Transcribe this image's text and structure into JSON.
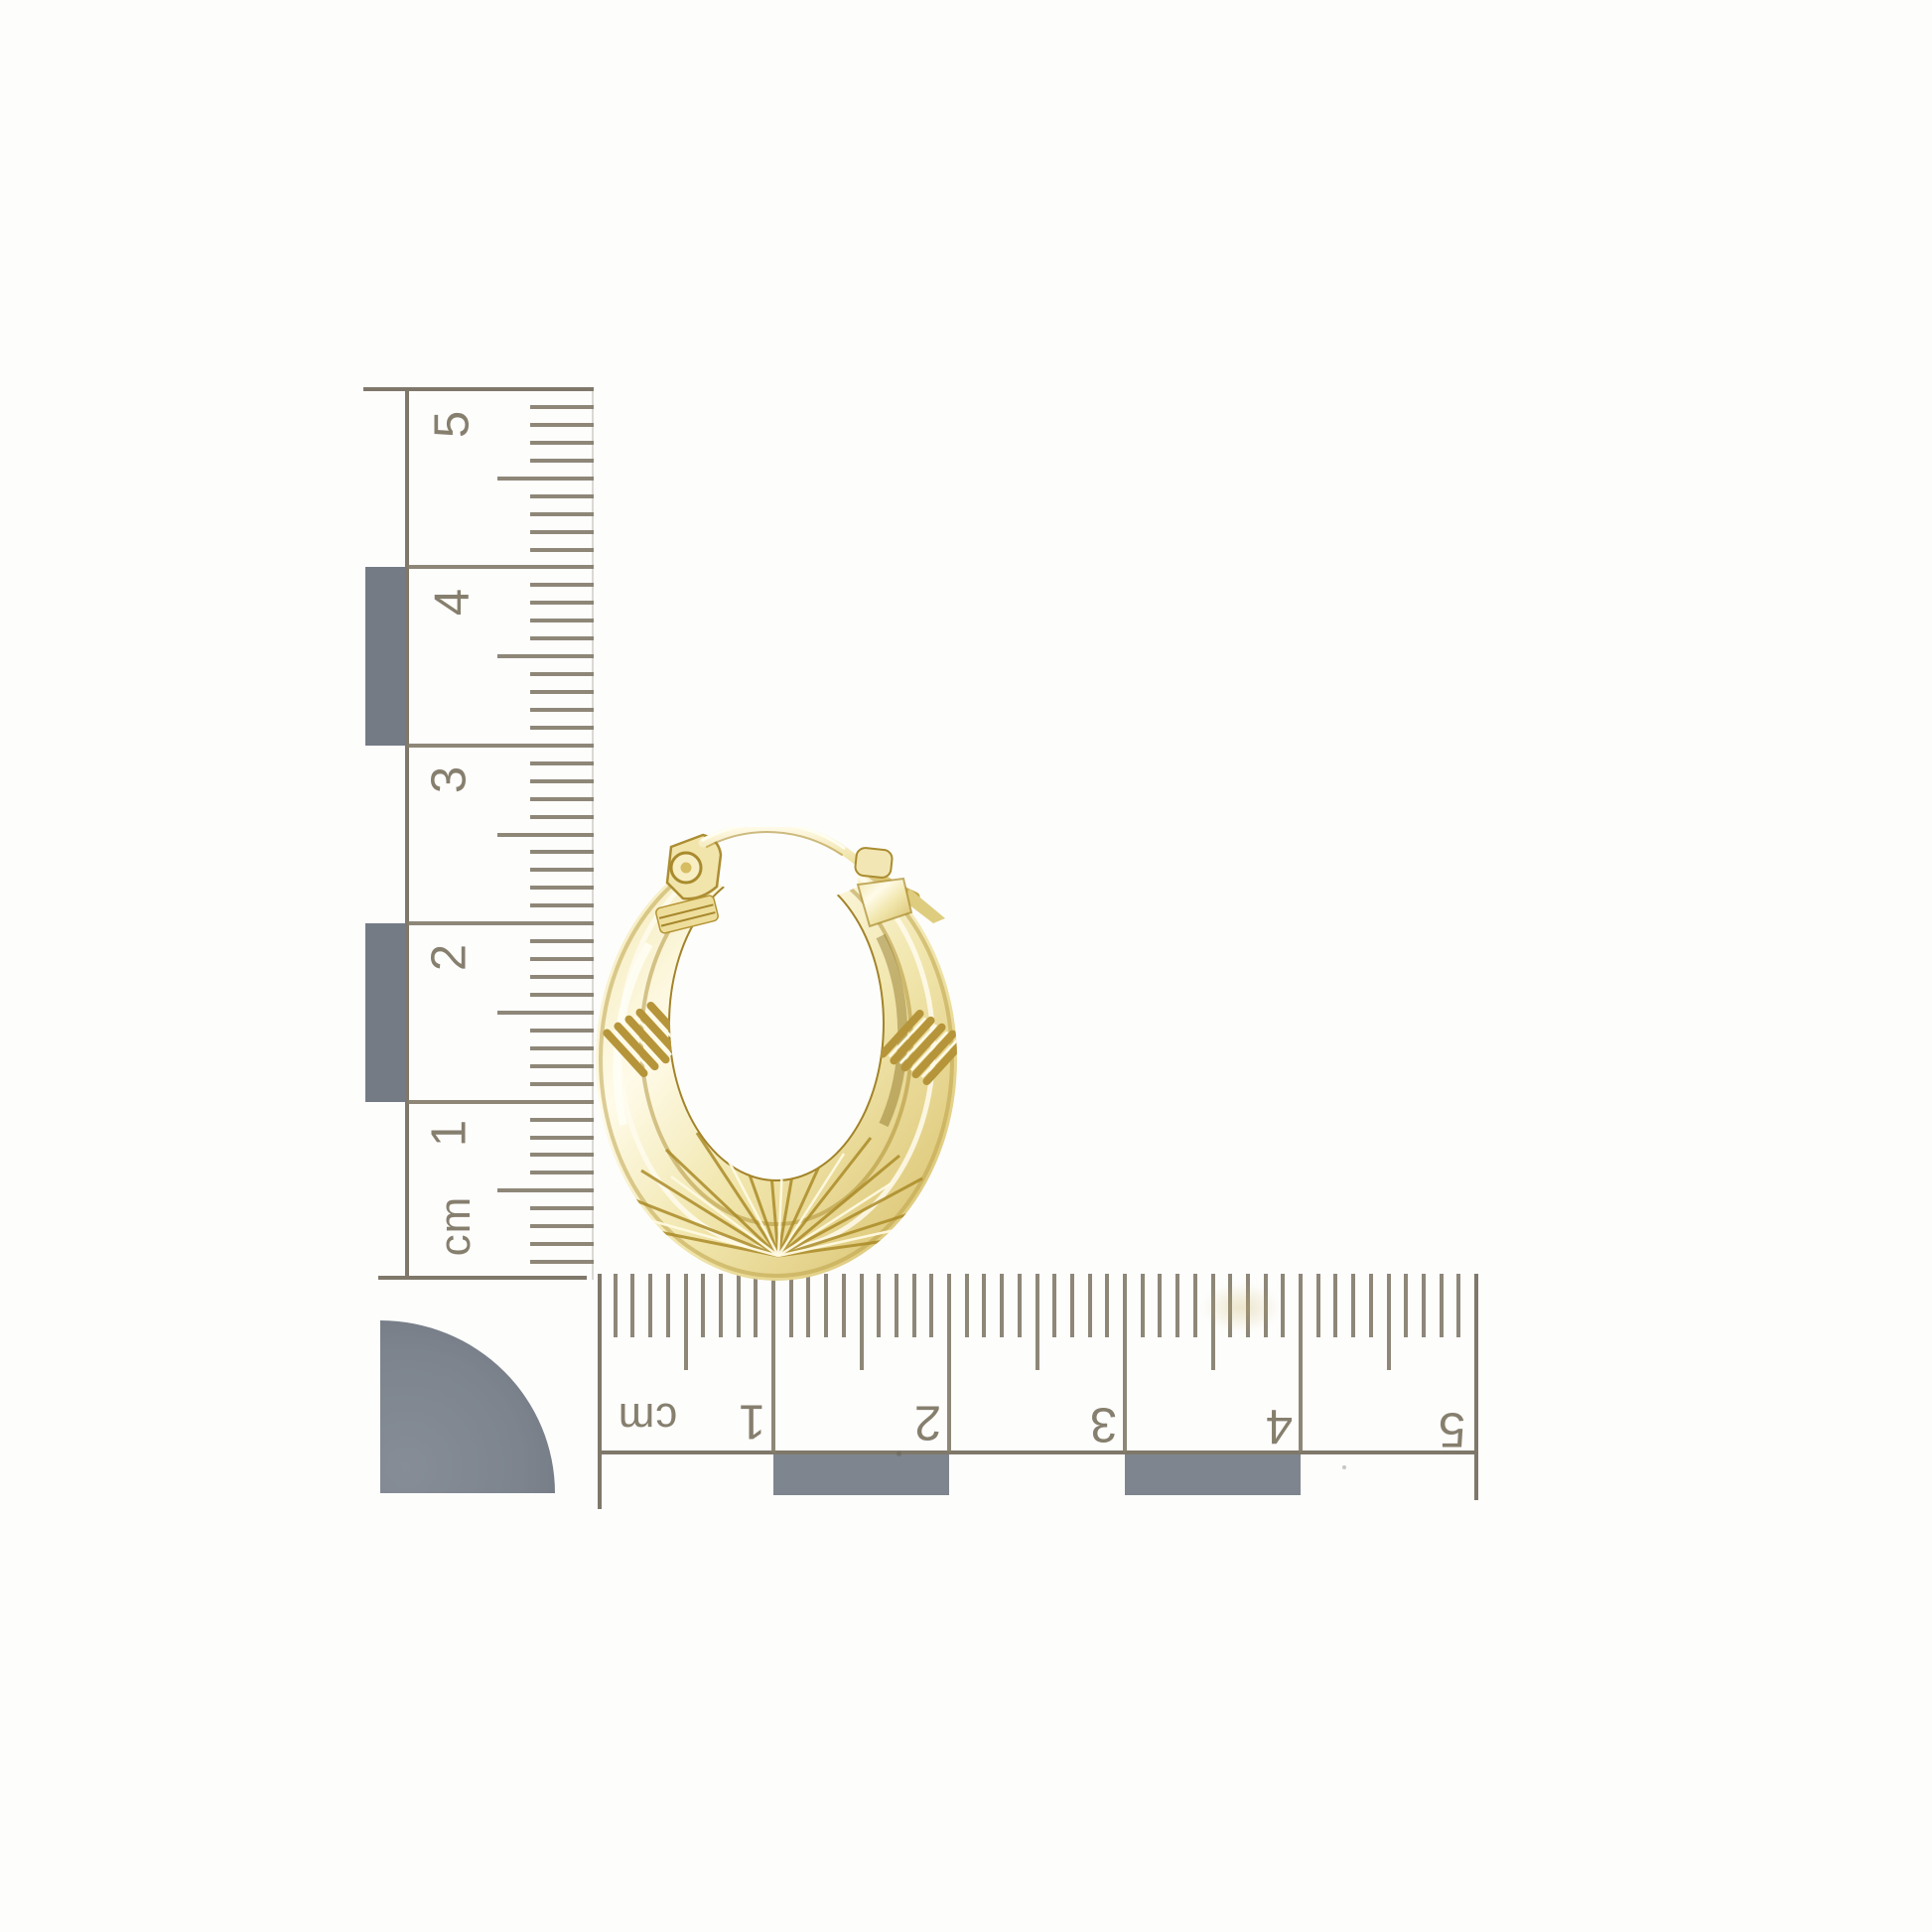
{
  "scene": {
    "description": "Gold oval creole hoop earring photographed on a white background beside two centimetre scale rulers and a quarter-circle corner marker",
    "background_color": "#fdfdfc"
  },
  "vertical_ruler": {
    "unit_label": "cm",
    "labels": [
      "5",
      "4",
      "3",
      "2",
      "1"
    ],
    "tick_color": "#847d6d",
    "block_color": "#747b85",
    "orientation": "labels rotated -90deg, reads bottom to top"
  },
  "horizontal_ruler": {
    "unit_label": "cm",
    "labels": [
      "1",
      "2",
      "3",
      "4",
      "5"
    ],
    "tick_color": "#847d6d",
    "block_color": "#7e858e",
    "orientation": "upside-down (rotated 180deg)"
  },
  "corner_marker": {
    "shape": "quarter-circle",
    "color": "#7d848e"
  },
  "earring": {
    "type": "oval creole hoop earring",
    "finish": "polished yellow gold",
    "gold_light": "#fffbe9",
    "gold_base": "#f1e6ad",
    "gold_mid": "#e2cf85",
    "gold_shadow": "#b3922d",
    "gold_deep": "#8a6d14",
    "details": "rope twist bands on both shoulders, sunburst engraving at base, hinged post and latch-wire clasp at top"
  }
}
